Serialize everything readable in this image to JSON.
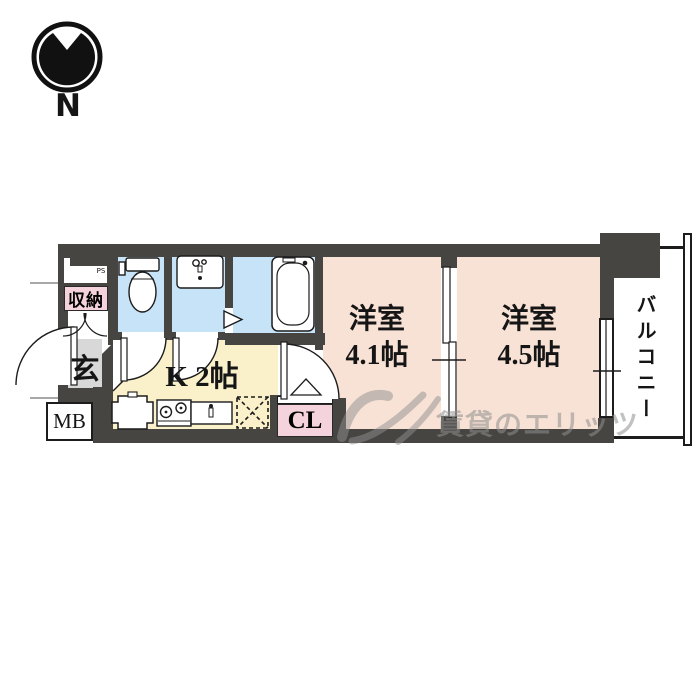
{
  "compass": {
    "label": "N"
  },
  "rooms": {
    "pipe_space": {
      "label": "PS"
    },
    "storage": {
      "label": "収納"
    },
    "entrance": {
      "label": "玄"
    },
    "meter_box": {
      "label": "MB"
    },
    "kitchen": {
      "label": "K 2帖"
    },
    "closet": {
      "label": "CL"
    },
    "western_room_41": {
      "name": "洋室",
      "size": "4.1帖"
    },
    "western_room_45": {
      "name": "洋室",
      "size": "4.5帖"
    },
    "balcony": {
      "label": "バルコニー"
    }
  },
  "watermark": {
    "text": "賃貸のエリッツ"
  },
  "colors": {
    "wall": "#474542",
    "wet_area_blue": "#c6e3f7",
    "room_peach": "#f8e2d5",
    "kitchen_cream": "#faf0ca",
    "entrance_gray": "#d8d8d8",
    "label_pink": "#f5d3dc",
    "watermark_gray": "#8f8f8f"
  }
}
